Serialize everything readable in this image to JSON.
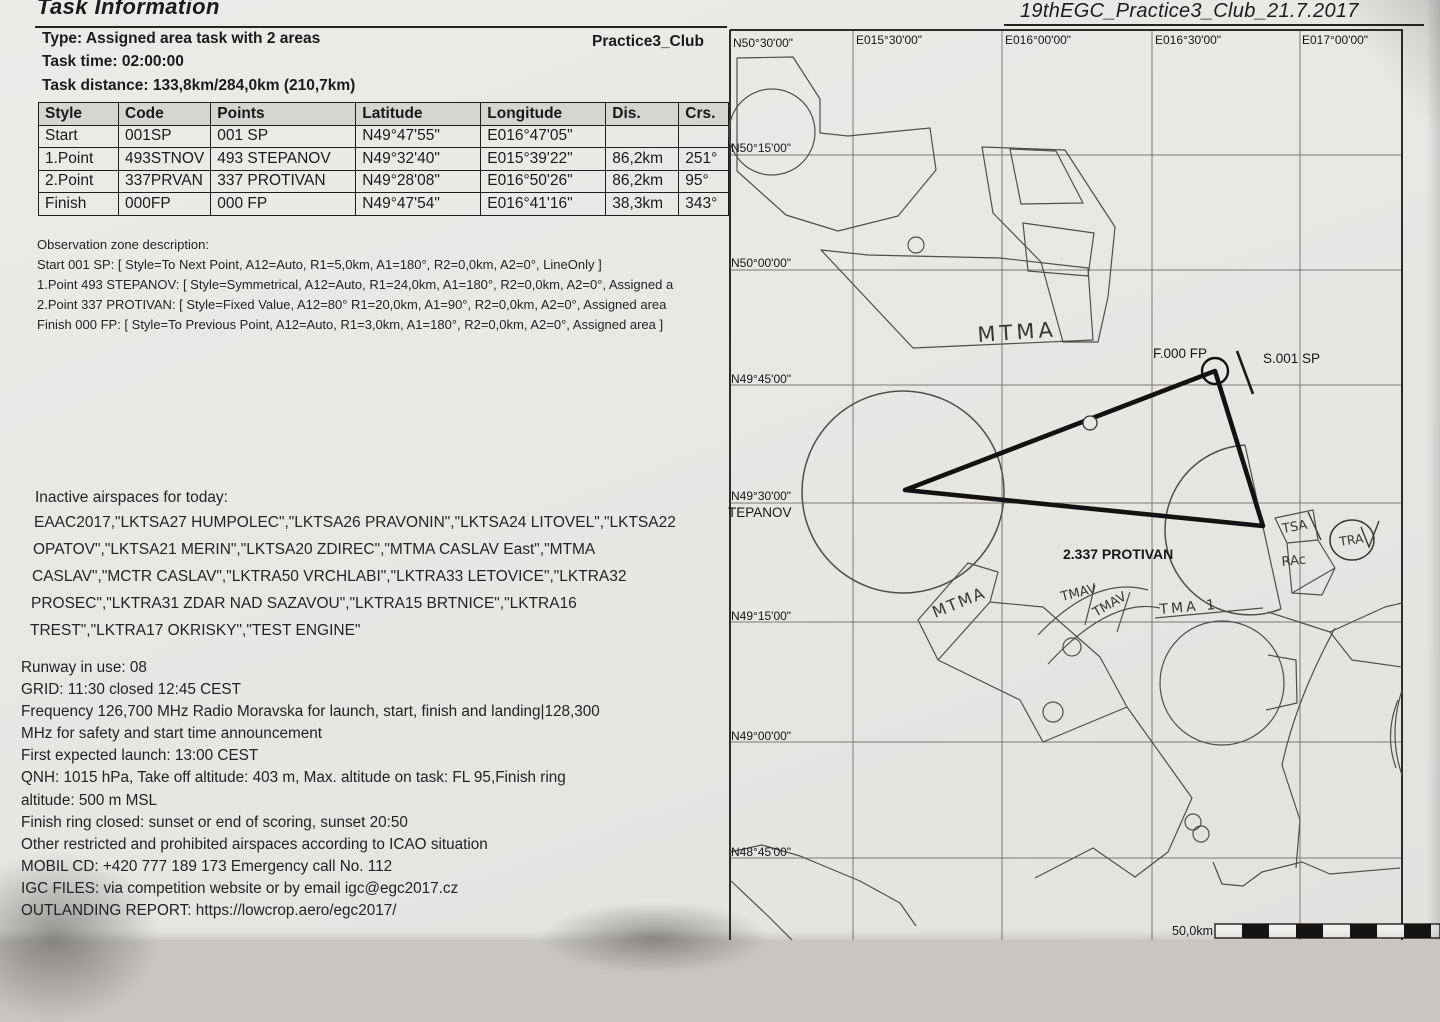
{
  "doc": {
    "title": "Task Information",
    "header_right": "19thEGC_Practice3_Club_21.7.2017",
    "task_name": "Practice3_Club",
    "type_line": "Type: Assigned area task with 2 areas",
    "time_line": "Task time: 02:00:00",
    "distance_line": "Task distance: 133,8km/284,0km (210,7km)"
  },
  "waypoints": {
    "columns": [
      "Style",
      "Code",
      "Points",
      "Latitude",
      "Longitude",
      "Dis.",
      "Crs."
    ],
    "rows": [
      [
        "Start",
        "001SP",
        "001 SP",
        "N49°47'55\"",
        "E016°47'05\"",
        "",
        ""
      ],
      [
        "1.Point",
        "493STNOV",
        "493 STEPANOV",
        "N49°32'40\"",
        "E015°39'22\"",
        "86,2km",
        "251°"
      ],
      [
        "2.Point",
        "337PRVAN",
        "337 PROTIVAN",
        "N49°28'08\"",
        "E016°50'26\"",
        "86,2km",
        "95°"
      ],
      [
        "Finish",
        "000FP",
        "000 FP",
        "N49°47'54\"",
        "E016°41'16\"",
        "38,3km",
        "343°"
      ]
    ]
  },
  "obszones": {
    "heading": "Observation zone description:",
    "lines": [
      "Start 001 SP: [ Style=To Next Point, A12=Auto, R1=5,0km, A1=180°, R2=0,0km, A2=0°, LineOnly ]",
      "1.Point 493 STEPANOV: [ Style=Symmetrical, A12=Auto, R1=24,0km, A1=180°, R2=0,0km, A2=0°, Assigned a",
      "2.Point 337 PROTIVAN: [ Style=Fixed Value, A12=80° R1=20,0km, A1=90°, R2=0,0km, A2=0°, Assigned area",
      "Finish 000 FP: [ Style=To Previous Point, A12=Auto, R1=3,0km, A1=180°, R2=0,0km, A2=0°, Assigned area ]"
    ]
  },
  "airspaces": {
    "heading": "Inactive airspaces for today:",
    "lines": [
      "EAAC2017,\"LKTSA27 HUMPOLEC\",\"LKTSA26 PRAVONIN\",\"LKTSA24 LITOVEL\",\"LKTSA22",
      "OPATOV\",\"LKTSA21 MERIN\",\"LKTSA20 ZDIREC\",\"MTMA CASLAV East\",\"MTMA",
      "CASLAV\",\"MCTR CASLAV\",\"LKTRA50 VRCHLABI\",\"LKTRA33 LETOVICE\",\"LKTRA32",
      "PROSEC\",\"LKTRA31 ZDAR NAD SAZAVOU\",\"LKTRA15 BRTNICE\",\"LKTRA16",
      "TREST\",\"LKTRA17 OKRISKY\",\"TEST ENGINE\""
    ]
  },
  "briefing": {
    "lines": [
      "Runway in use: 08",
      "GRID: 11:30 closed 12:45 CEST",
      "Frequency 126,700 MHz Radio Moravska for launch, start, finish and landing|128,300",
      "MHz for safety and start time announcement",
      "First expected launch: 13:00 CEST",
      "QNH: 1015 hPa, Take off altitude: 403 m, Max. altitude on task: FL 95,Finish ring",
      "altitude: 500 m MSL",
      "Finish ring closed: sunset or end of scoring, sunset 20:50",
      "Other restricted and prohibited airspaces according to ICAO situation",
      "MOBIL CD: +420 777 189 173 Emergency call No. 112",
      "IGC FILES: via competition website or by email igc@egc2017.cz",
      "OUTLANDING REPORT: https://lowcrop.aero/egc2017/"
    ]
  },
  "map": {
    "lat_labels": [
      "N50°30'00\"",
      "N50°15'00\"",
      "N50°00'00\"",
      "N49°45'00\"",
      "N49°30'00\"",
      "N49°15'00\"",
      "N49°00'00\"",
      "N48°45'00\""
    ],
    "lon_labels": [
      "E015°30'00\"",
      "E016°00'00\"",
      "E016°30'00\"",
      "E017°00'00\""
    ],
    "labels": {
      "finish": "F.000 FP",
      "start": "S.001 SP",
      "turnpoint2": "2.337 PROTIVAN",
      "turnpoint1_partial": "TEPANOV",
      "scale": "50,0km"
    },
    "handwritten": [
      "MTMA",
      "MTMA",
      "TMAV",
      "TMAV",
      "TMA 1",
      "TSA",
      "RAc",
      "TRA"
    ]
  }
}
